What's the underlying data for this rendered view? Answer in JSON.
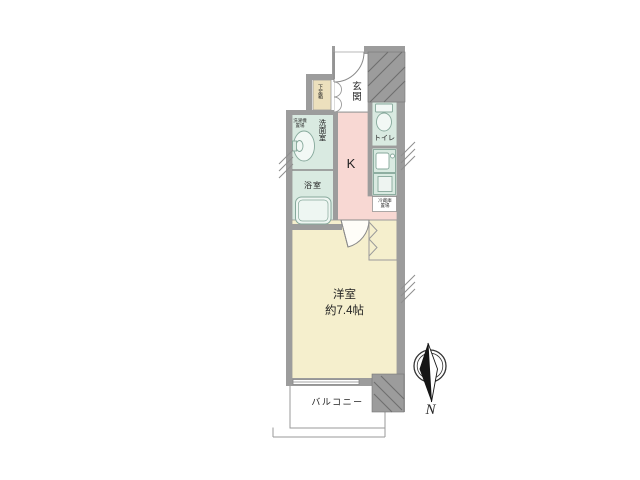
{
  "floorplan": {
    "labels": {
      "entrance": "玄関",
      "shoe_box": "下足箱",
      "toilet": "トイレ",
      "washroom": "洗面室",
      "washer_place_line1": "洗濯機",
      "washer_place_line2": "置場",
      "bathroom": "浴室",
      "kitchen": "K",
      "fridge_place_line1": "冷蔵庫",
      "fridge_place_line2": "置場",
      "main_room": "洋室",
      "main_room_size": "約7.4帖",
      "balcony": "バルコニー",
      "compass_north": "N"
    },
    "colors": {
      "wall_gray": "#9c9c9c",
      "hatch_line": "#6f6f6f",
      "wet_room_green": "#d9eae1",
      "kitchen_floor_pink": "#f8d8d3",
      "main_room_cream": "#f5efcd",
      "shoe_box_tan": "#ece0bd",
      "outline_gray": "#8a8a8a"
    }
  }
}
